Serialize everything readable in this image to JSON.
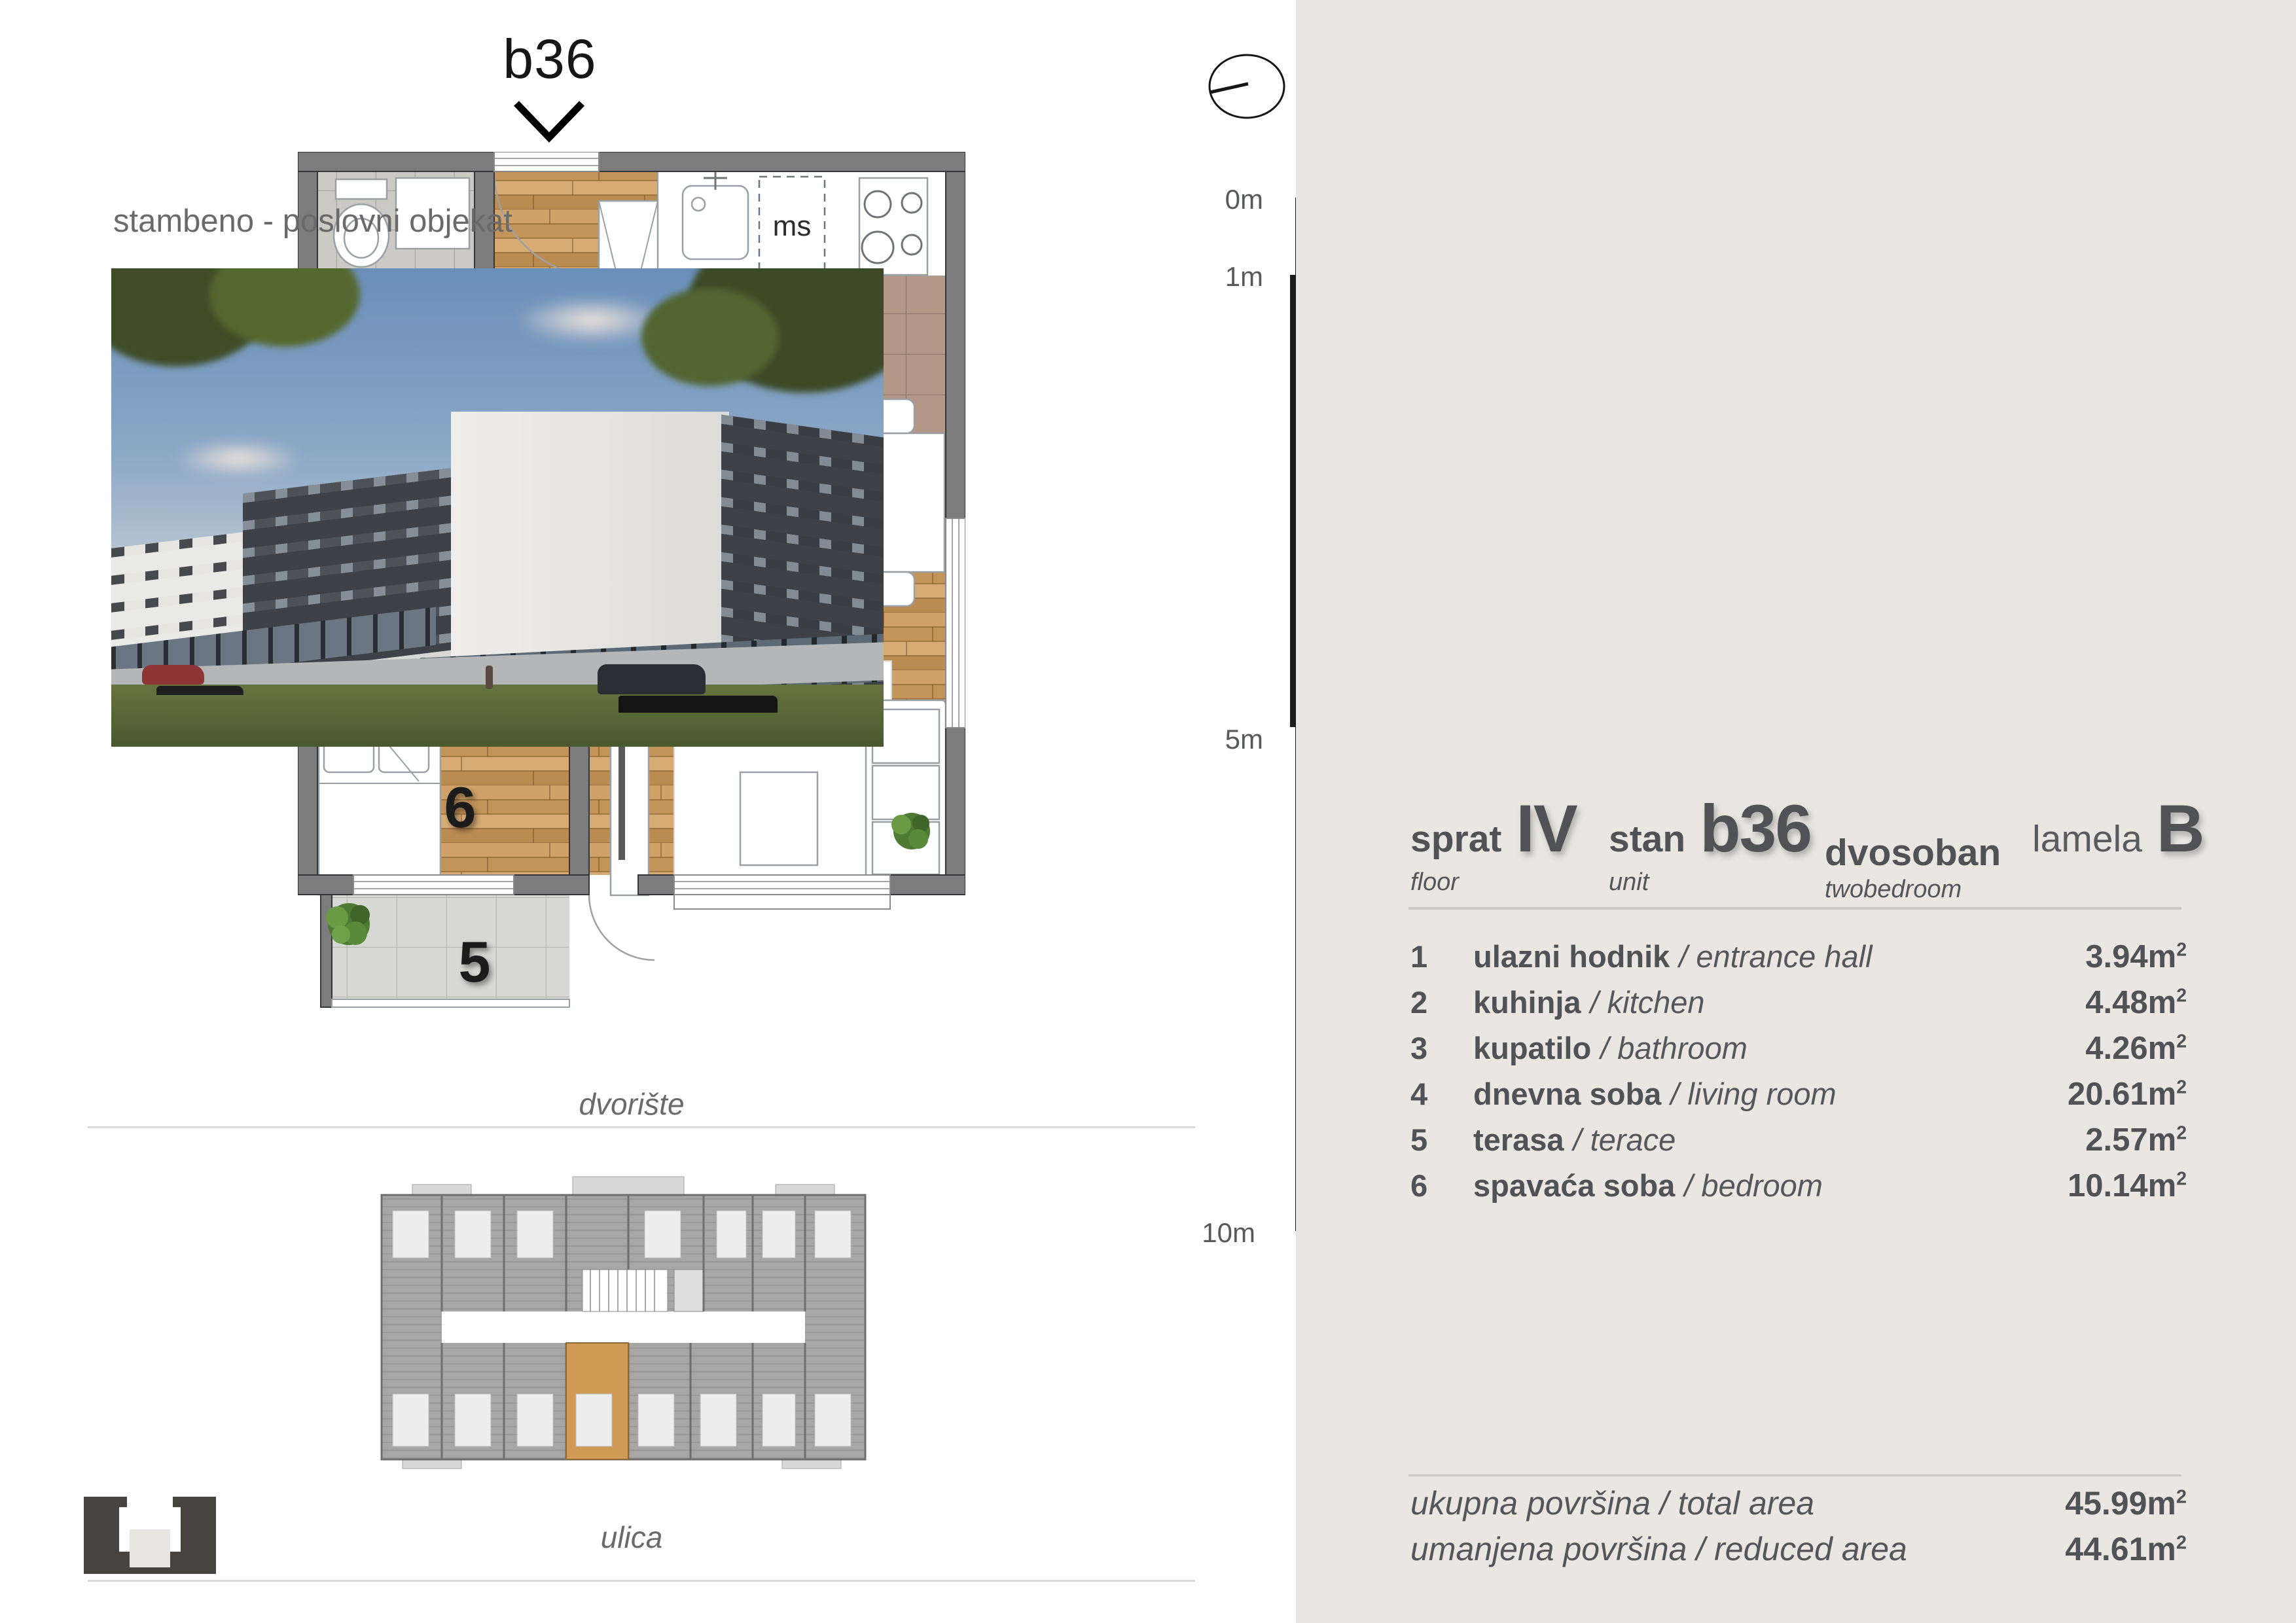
{
  "plan": {
    "title": "b36",
    "numbers": [
      "1",
      "2",
      "3",
      "4",
      "5",
      "6"
    ],
    "ms": "ms",
    "dvoriste": "dvorište",
    "ulica": "ulica"
  },
  "scale_bar": {
    "labels": [
      "0m",
      "1m",
      "5m",
      "10m"
    ]
  },
  "right": {
    "header": "stambeno - poslovni objekat",
    "unit": {
      "sprat_label": "sprat",
      "sprat_value": "IV",
      "sprat_sub": "floor",
      "stan_label": "stan",
      "stan_value": "b36",
      "stan_sub": "unit",
      "type_label": "dvosoban",
      "type_sub": "twobedroom",
      "lamela_label": "lamela",
      "lamela_value": "B"
    },
    "rooms": [
      {
        "num": "1",
        "name": "ulazni hodnik",
        "en": "/ entrance hall",
        "area": "3.94"
      },
      {
        "num": "2",
        "name": "kuhinja",
        "en": "/ kitchen",
        "area": "4.48"
      },
      {
        "num": "3",
        "name": "kupatilo",
        "en": "/ bathroom",
        "area": "4.26"
      },
      {
        "num": "4",
        "name": "dnevna soba",
        "en": "/ living room",
        "area": "20.61"
      },
      {
        "num": "5",
        "name": "terasa",
        "en": "/ terace",
        "area": "2.57"
      },
      {
        "num": "6",
        "name": "spavaća soba",
        "en": "/ bedroom",
        "area": "10.14"
      }
    ],
    "totals": [
      {
        "label": "ukupna površina / total area",
        "value": "45.99"
      },
      {
        "label": "umanjena površina / reduced area",
        "value": "44.61"
      }
    ],
    "units": {
      "m": "m",
      "exp": "2"
    }
  },
  "colors": {
    "panel_bg": "#eae7e2",
    "text_dark": "#515256",
    "text_gray": "#6a6a6a",
    "wood": "#c9995f",
    "highlight": "#cf9a55",
    "wall": "#7c7c7c"
  }
}
